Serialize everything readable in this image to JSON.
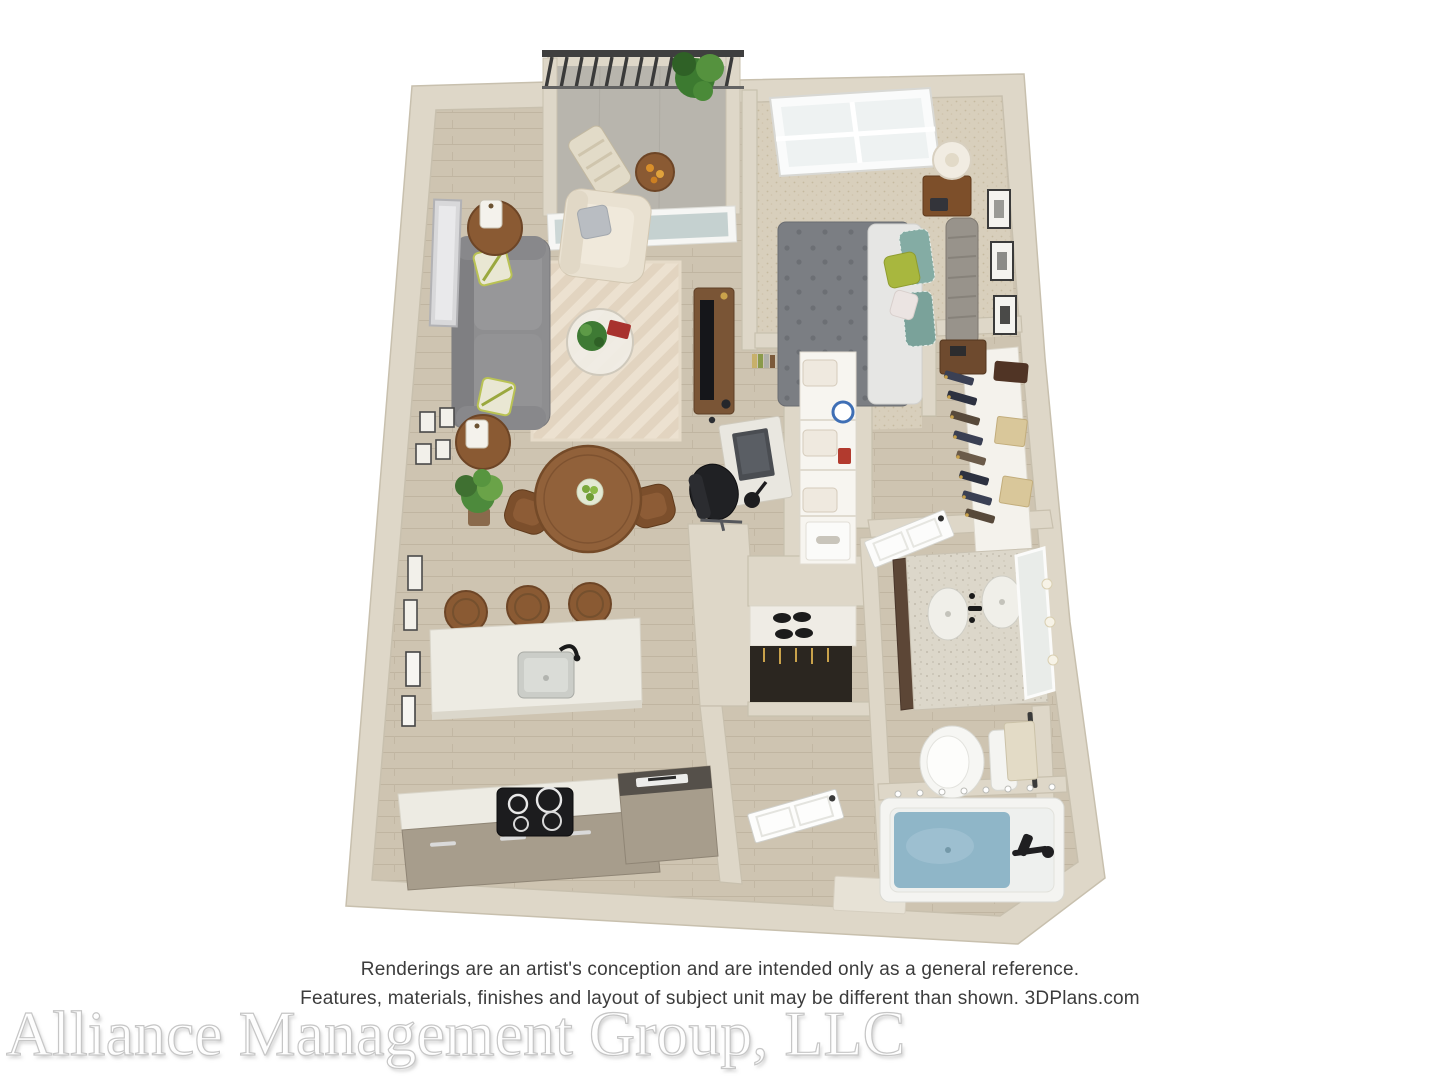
{
  "disclaimer": {
    "line1": "Renderings are an artist's conception and are intended only as a general reference.",
    "line2": "Features, materials, finishes and layout of subject unit may be different than shown. 3DPlans.com",
    "color": "#3c3c3c"
  },
  "watermark": {
    "text": "Alliance Management Group, LLC",
    "fill": "#ffffff",
    "outline": "#c6c6c6"
  },
  "floorplan": {
    "type": "3d-apartment-floor-plan-rendering",
    "rooms": [
      "balcony",
      "living-room",
      "dining-area",
      "desk-nook",
      "kitchen",
      "bedroom",
      "walk-in-closet",
      "linen-closet",
      "coat-closet",
      "entry",
      "bathroom"
    ],
    "furniture": [
      "railing",
      "patio-chair",
      "patio-table",
      "potted-plant",
      "sliding-glass-door",
      "sofa",
      "armchair",
      "side-table",
      "lantern",
      "area-rug",
      "coffee-table",
      "media-console",
      "tv",
      "leaning-mirror",
      "gallery-frames",
      "dining-table",
      "dining-chairs",
      "floor-plant",
      "desk",
      "office-chair",
      "books",
      "kitchen-island",
      "sink",
      "bar-stools",
      "cooktop",
      "kitchen-cabinets",
      "refrigerator",
      "bed",
      "headboard",
      "nightstand",
      "table-lamp",
      "window",
      "wall-art",
      "dresser",
      "hanging-clothes",
      "storage-boxes",
      "towel-shelves",
      "detergent",
      "shoe-shelf",
      "coats",
      "front-door",
      "bathroom-door",
      "vanity",
      "sinks",
      "mirror-panel",
      "toilet",
      "towel-rack",
      "bathtub",
      "shower-fixture"
    ],
    "colors": {
      "wall": "#ded7c8",
      "wall_edge": "#c8c0ae",
      "wood_floor": "#cec4b1",
      "carpet": "#d8cfbc",
      "rug": "#ece1d0",
      "sofa": "#8e8e90",
      "accent_green": "#a8b73e",
      "counter_white": "#edebe3",
      "cabinet_taupe": "#a79d8c",
      "tub_water": "#8fb6c8",
      "railing_dark": "#3f3f3f",
      "wood_furniture": "#8a5a33"
    }
  }
}
